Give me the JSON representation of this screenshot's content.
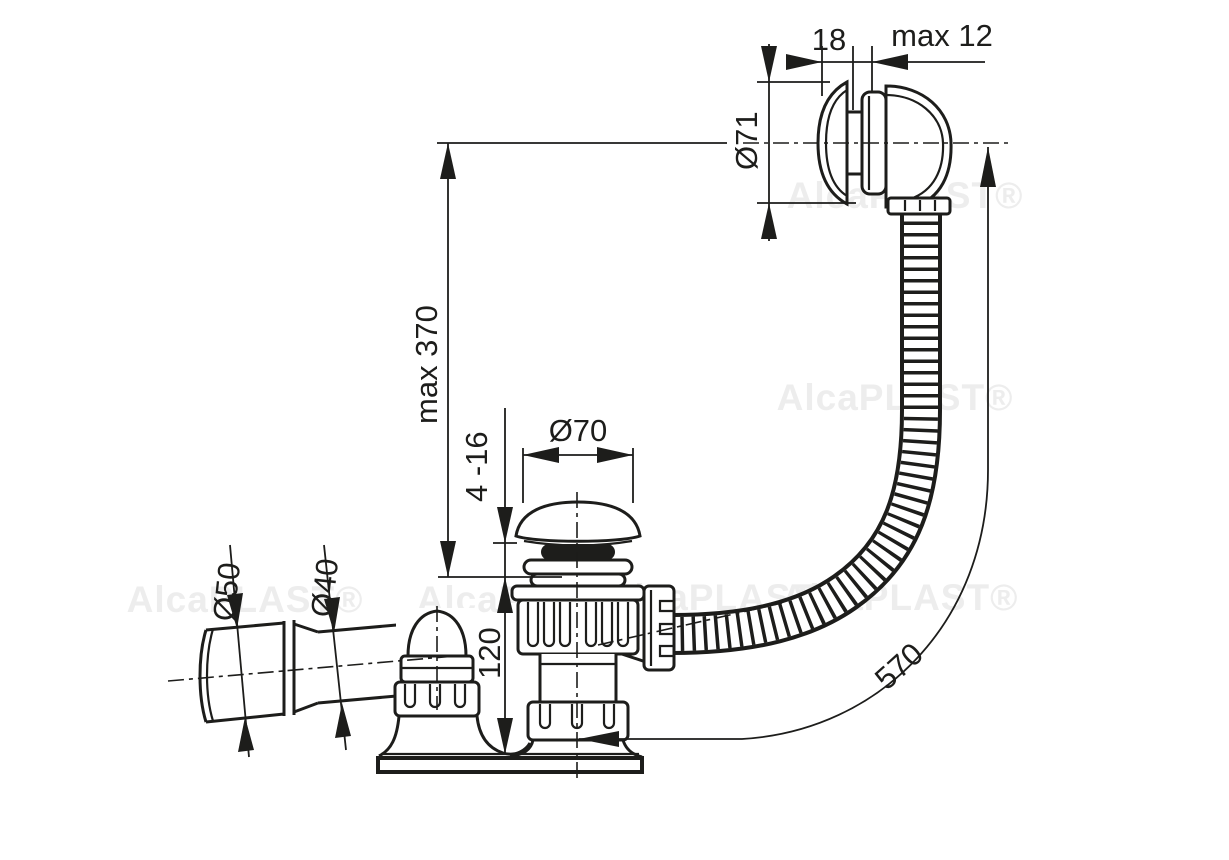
{
  "drawing": {
    "background": "#ffffff",
    "line_color": "#1d1d1b",
    "watermark": {
      "text": "AlcaPLAST®",
      "color": "#ededed"
    }
  },
  "labels": {
    "overflow_cap_offset": "18",
    "panel_max_thickness": "max 12",
    "overflow_diameter": "Ø71",
    "overflow_hose_height": "max 370",
    "waste_cap_diameter": "Ø70",
    "bath_bottom_thickness": "4 -16",
    "outlet_diameter_50": "Ø50",
    "outlet_diameter_40": "Ø40",
    "waste_body_height": "120",
    "hose_length": "570"
  }
}
